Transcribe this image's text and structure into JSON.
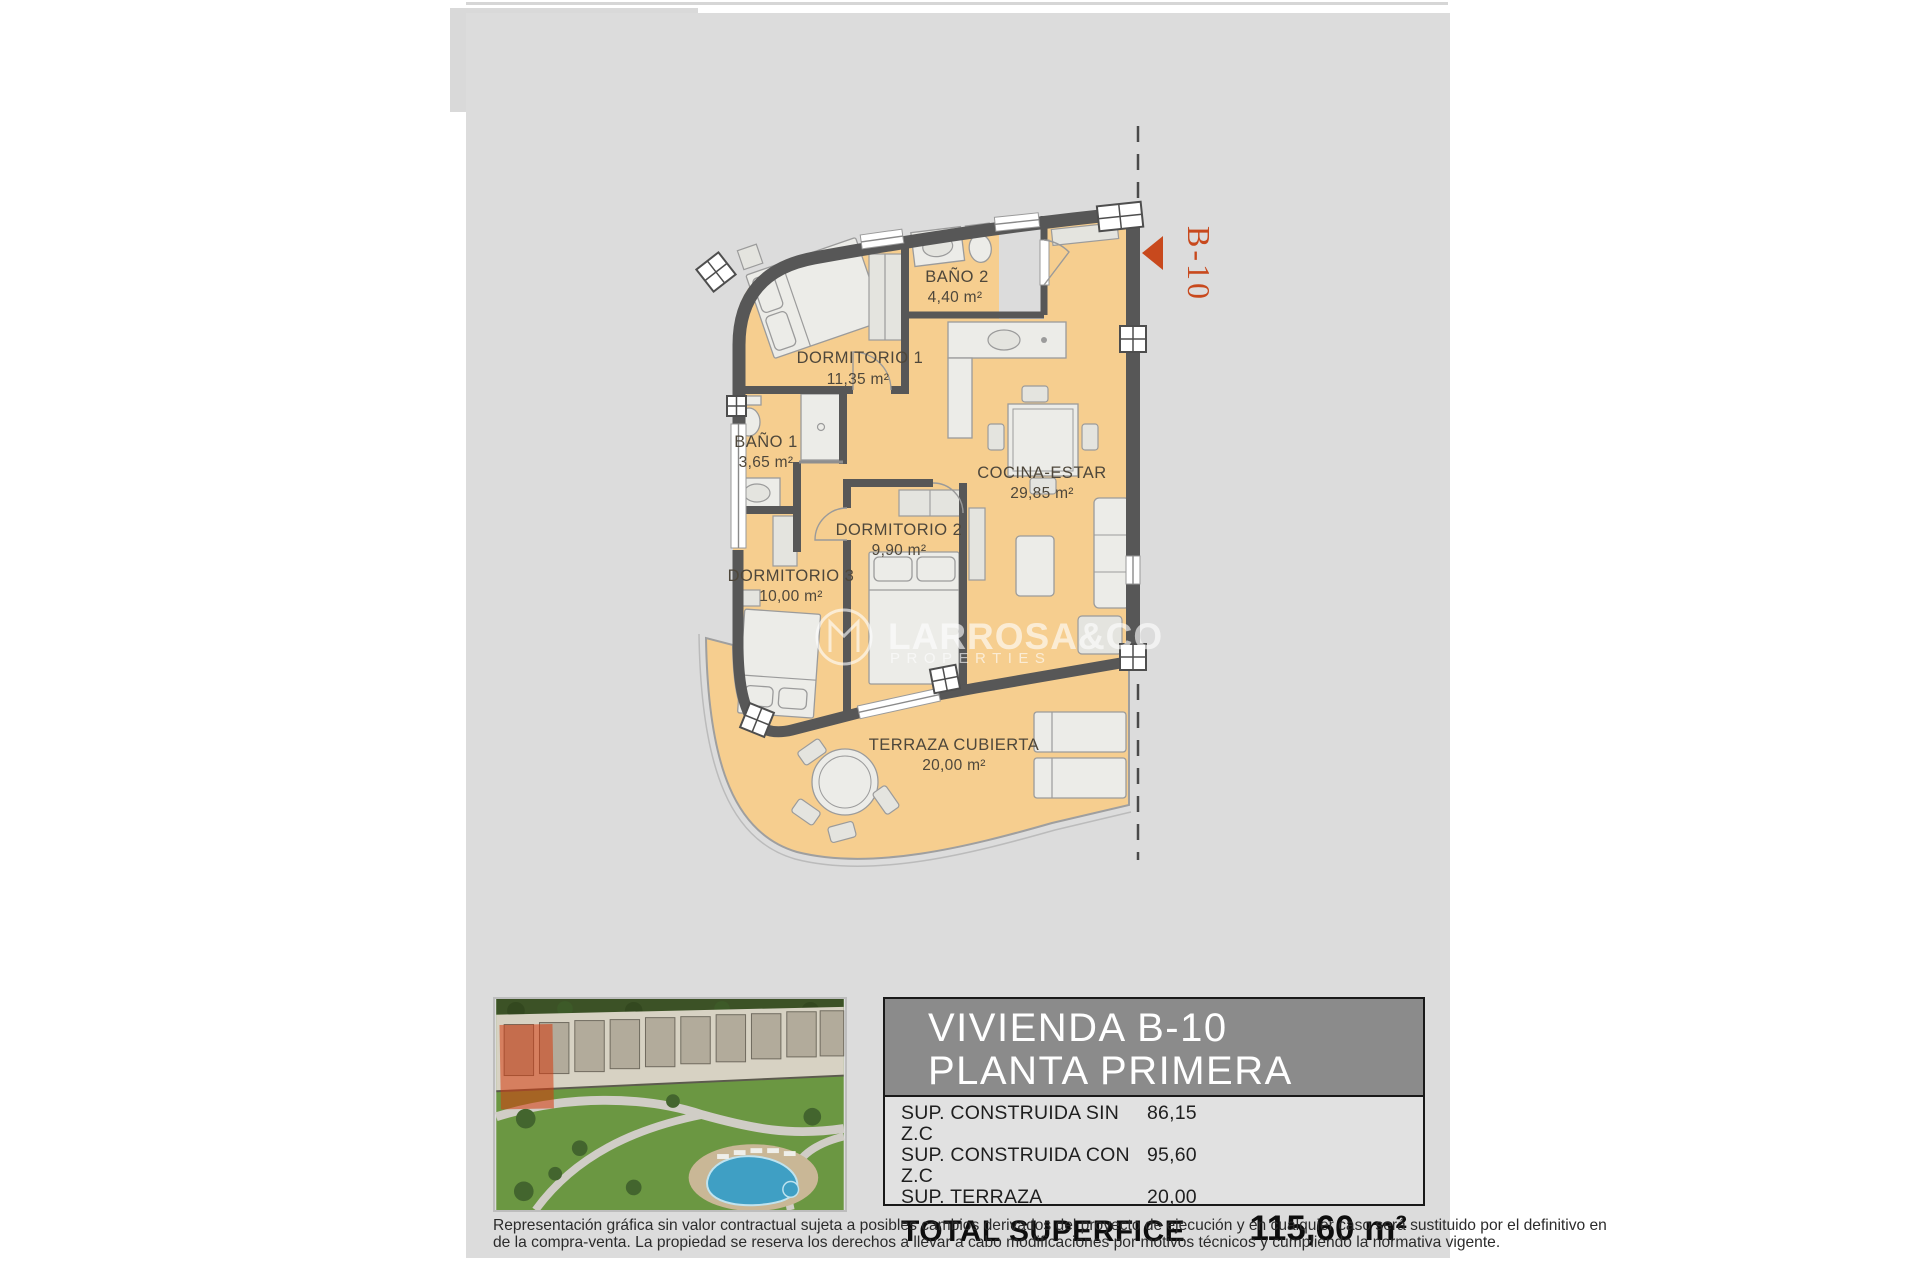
{
  "plan": {
    "unit_label": "B-10",
    "rooms": [
      {
        "name": "BAÑO 2",
        "area": "4,40 m²"
      },
      {
        "name": "DORMITORIO 1",
        "area": "11,35 m²"
      },
      {
        "name": "BAÑO 1",
        "area": "3,65 m²"
      },
      {
        "name": "COCINA-ESTAR",
        "area": "29,85 m²"
      },
      {
        "name": "DORMITORIO 2",
        "area": "9,90 m²"
      },
      {
        "name": "DORMITORIO 3",
        "area": "10,00 m²"
      },
      {
        "name": "TERRAZA CUBIERTA",
        "area": "20,00 m²"
      }
    ],
    "watermark": {
      "brand": "LARROSA&CO",
      "tagline": "PROPERTIES"
    }
  },
  "info": {
    "title_line1": "VIVIENDA B-10",
    "title_line2": "PLANTA PRIMERA",
    "measurements": [
      {
        "label": "SUP. CONSTRUIDA SIN Z.C",
        "value": "86,15"
      },
      {
        "label": "SUP. CONSTRUIDA CON Z.C",
        "value": "95,60"
      },
      {
        "label": "SUP. TERRAZA",
        "value": "20,00"
      }
    ],
    "total_label": "TOTAL SUPERFICE",
    "total_value": "115,60 m²"
  },
  "disclaimer": {
    "line1": "Representación gráfica sin valor contractual sujeta a posibles cambios derivados del proyecto de ejecución y en cualquier caso será sustituido por el definitivo en",
    "line2": "de la compra-venta. La propiedad se reserva los derechos a llevar a cabo modificaciones por motivos técnicos y cumpliendo la normativa vigente."
  },
  "colors": {
    "floor_orange": "#f6ce8f",
    "wall_gray": "#575757",
    "accent_red": "#c8491d",
    "title_bar_gray": "#8b8b8b",
    "sheet_gray": "#dcdcdc"
  }
}
